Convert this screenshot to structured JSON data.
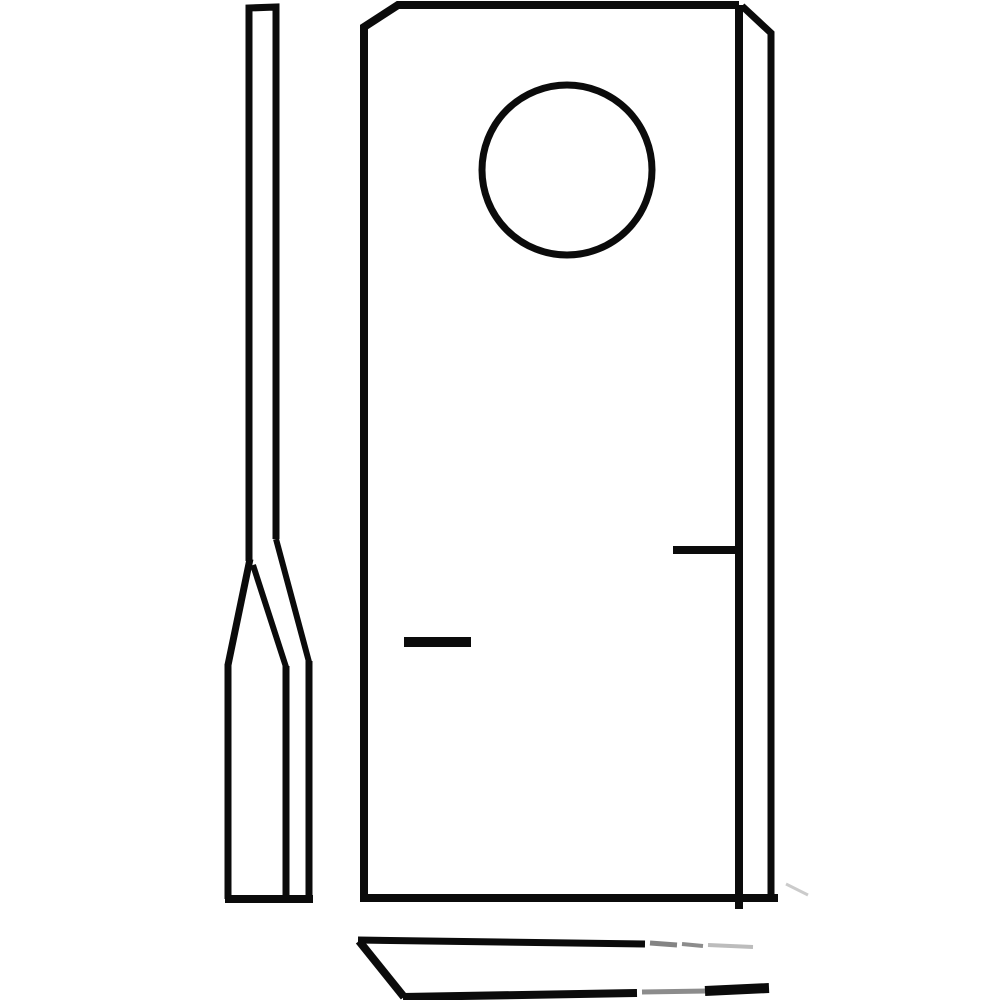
{
  "page": {
    "background": "#ffffff"
  },
  "drawing": {
    "colors": {
      "ink": "#0b0b0b",
      "faded": "#6f6f6f",
      "ghost": "#b5b5b5"
    },
    "viewbox": [
      0,
      0,
      1000,
      1000
    ],
    "hole": {
      "cx": 567,
      "cy": 170,
      "r": 85
    },
    "shapes": [
      {
        "name": "side-view-upper-strip-outline",
        "type": "polyline",
        "points": [
          [
            249,
            561
          ],
          [
            249,
            8
          ],
          [
            276,
            7
          ],
          [
            276,
            539
          ]
        ],
        "width": 7
      },
      {
        "name": "side-view-bevel-left-edge",
        "type": "polyline",
        "points": [
          [
            250,
            559
          ],
          [
            228,
            665
          ]
        ],
        "width": 7
      },
      {
        "name": "side-view-bevel-grind-line",
        "type": "polyline",
        "points": [
          [
            253,
            565
          ],
          [
            286,
            667
          ]
        ],
        "width": 6
      },
      {
        "name": "side-view-bevel-right-edge",
        "type": "polyline",
        "points": [
          [
            276,
            539
          ],
          [
            309,
            662
          ]
        ],
        "width": 6
      },
      {
        "name": "side-view-lower-strip-left-edge",
        "type": "polyline",
        "points": [
          [
            228,
            664
          ],
          [
            228,
            899
          ]
        ],
        "width": 7
      },
      {
        "name": "side-view-lower-strip-grind-line",
        "type": "polyline",
        "points": [
          [
            286,
            666
          ],
          [
            286,
            899
          ]
        ],
        "width": 7
      },
      {
        "name": "side-view-lower-strip-right-edge",
        "type": "polyline",
        "points": [
          [
            309,
            661
          ],
          [
            309,
            899
          ]
        ],
        "width": 7
      },
      {
        "name": "side-view-bottom-edge",
        "type": "polyline",
        "points": [
          [
            225,
            899
          ],
          [
            313,
            899
          ]
        ],
        "width": 8
      },
      {
        "name": "front-view-left-and-top-outline",
        "type": "polyline",
        "points": [
          [
            364,
            899
          ],
          [
            364,
            27
          ],
          [
            398,
            5
          ],
          [
            739,
            5
          ]
        ],
        "width": 8
      },
      {
        "name": "front-view-inner-right-edge",
        "type": "polyline",
        "points": [
          [
            739,
            5
          ],
          [
            739,
            909
          ]
        ],
        "width": 8
      },
      {
        "name": "front-view-right-lip-edge",
        "type": "polyline",
        "points": [
          [
            742,
            6
          ],
          [
            771,
            33
          ],
          [
            771,
            897
          ]
        ],
        "width": 7
      },
      {
        "name": "front-view-bottom-edge",
        "type": "polyline",
        "points": [
          [
            360,
            898
          ],
          [
            778,
            898
          ]
        ],
        "width": 8
      },
      {
        "name": "bolt-hole",
        "type": "circle",
        "cx": 567,
        "cy": 170,
        "r": 85,
        "width": 7
      },
      {
        "name": "left-edge-tick-mark",
        "type": "polyline",
        "points": [
          [
            404,
            642
          ],
          [
            471,
            642
          ]
        ],
        "width": 10
      },
      {
        "name": "right-edge-tick-mark",
        "type": "polyline",
        "points": [
          [
            673,
            550
          ],
          [
            737,
            550
          ]
        ],
        "width": 8
      },
      {
        "name": "bottom-view-top-edge",
        "type": "polyline",
        "points": [
          [
            358,
            940
          ],
          [
            645,
            944
          ]
        ],
        "width": 7
      },
      {
        "name": "bottom-view-top-edge-faded-1",
        "type": "polyline",
        "points": [
          [
            650,
            943
          ],
          [
            677,
            945
          ]
        ],
        "width": 5,
        "color": "faded",
        "opacity": 0.85
      },
      {
        "name": "bottom-view-top-edge-faded-2",
        "type": "polyline",
        "points": [
          [
            682,
            944
          ],
          [
            703,
            946
          ]
        ],
        "width": 4,
        "color": "faded",
        "opacity": 0.8
      },
      {
        "name": "bottom-view-top-edge-faded-3",
        "type": "polyline",
        "points": [
          [
            708,
            945
          ],
          [
            753,
            947
          ]
        ],
        "width": 4,
        "color": "ghost",
        "opacity": 0.9
      },
      {
        "name": "bottom-view-left-bevel-edge",
        "type": "polyline",
        "points": [
          [
            359,
            941
          ],
          [
            404,
            997
          ]
        ],
        "width": 8
      },
      {
        "name": "bottom-view-bottom-edge",
        "type": "polyline",
        "points": [
          [
            403,
            997
          ],
          [
            637,
            993
          ]
        ],
        "width": 8
      },
      {
        "name": "bottom-view-bottom-edge-faded",
        "type": "polyline",
        "points": [
          [
            642,
            992
          ],
          [
            707,
            991
          ]
        ],
        "width": 5,
        "color": "faded",
        "opacity": 0.8
      },
      {
        "name": "bottom-view-bottom-edge-tip",
        "type": "polyline",
        "points": [
          [
            705,
            991
          ],
          [
            769,
            988
          ]
        ],
        "width": 10
      },
      {
        "name": "watermark-remnant-smudge",
        "type": "polyline",
        "points": [
          [
            786,
            884
          ],
          [
            808,
            895
          ]
        ],
        "width": 3,
        "color": "ghost",
        "opacity": 0.7
      }
    ]
  }
}
